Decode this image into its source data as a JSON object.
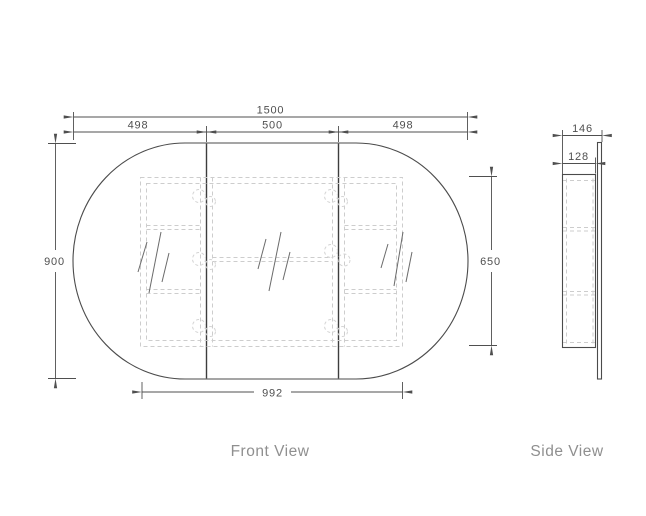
{
  "front_view": {
    "label": "Front View",
    "dimensions": {
      "overall_width": "1500",
      "door_left_width": "498",
      "door_middle_width": "500",
      "door_right_width": "498",
      "overall_height": "900",
      "carcass_height": "650",
      "carcass_width": "992"
    }
  },
  "side_view": {
    "label": "Side View",
    "dimensions": {
      "overall_depth": "146",
      "carcass_depth": "128"
    }
  },
  "colors": {
    "visible_edge": "#4b4b4b",
    "hidden_edge": "#cdcdcd",
    "dimension": "#4f4f4f",
    "view_label": "#8f8f8f",
    "background": "#ffffff"
  }
}
